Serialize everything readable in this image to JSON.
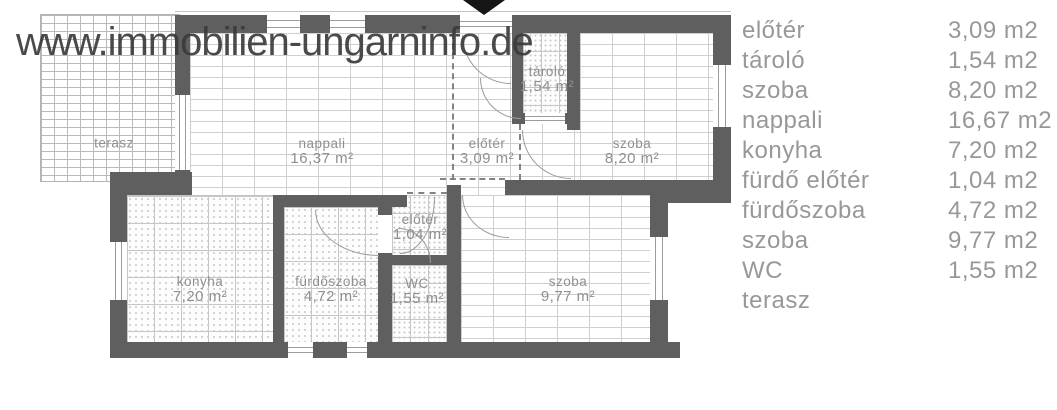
{
  "watermark": "www.immobilien-ungarninfo.de",
  "colors": {
    "wall": "#5f5f5f",
    "legend_text": "#98989a",
    "room_label_text": "#8f8f8f",
    "watermark_text": "#3b3b3b",
    "entrance_marker": "#161616"
  },
  "plan": {
    "rooms": [
      {
        "name": "terasz",
        "area": ""
      },
      {
        "name": "nappali",
        "area": "16,37 m²"
      },
      {
        "name": "előtér",
        "area": "3,09 m²"
      },
      {
        "name": "tároló",
        "area": "1,54 m²"
      },
      {
        "name": "szoba",
        "area": "8,20 m²"
      },
      {
        "name": "konyha",
        "area": "7,20 m²"
      },
      {
        "name": "fürdőszoba",
        "area": "4,72 m²"
      },
      {
        "name": "előtér",
        "area": "1,04 m²"
      },
      {
        "name": "WC",
        "area": "1,55 m²"
      },
      {
        "name": "szoba",
        "area": "9,77 m²"
      }
    ]
  },
  "legend": {
    "items": [
      {
        "label": "előtér",
        "value": "3,09 m2"
      },
      {
        "label": "tároló",
        "value": "1,54 m2"
      },
      {
        "label": "szoba",
        "value": "8,20 m2"
      },
      {
        "label": "nappali",
        "value": "16,67 m2"
      },
      {
        "label": "konyha",
        "value": "7,20 m2"
      },
      {
        "label": "fürdő előtér",
        "value": "1,04 m2"
      },
      {
        "label": "fürdőszoba",
        "value": "4,72 m2"
      },
      {
        "label": "szoba",
        "value": "9,77 m2"
      },
      {
        "label": "WC",
        "value": "1,55 m2"
      },
      {
        "label": "terasz",
        "value": ""
      }
    ]
  }
}
